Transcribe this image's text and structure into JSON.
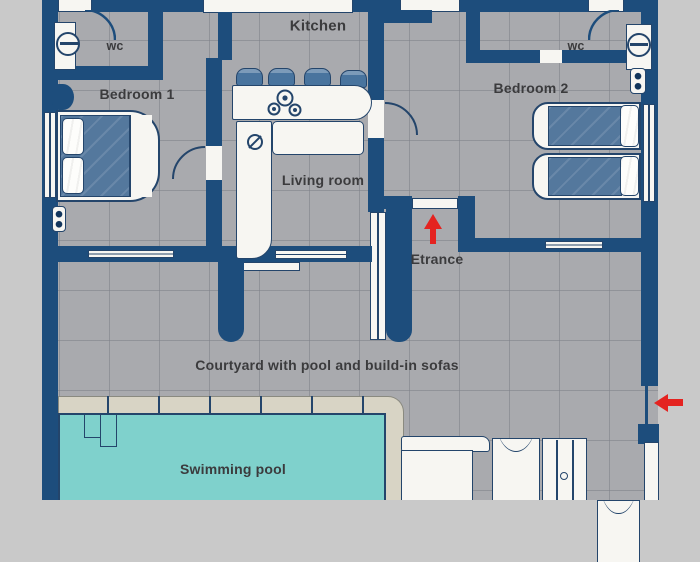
{
  "plan": {
    "type": "floor_plan",
    "labels": {
      "kitchen": "Kitchen",
      "wc_left": "wc",
      "wc_right": "wc",
      "bedroom1": "Bedroom 1",
      "bedroom2": "Bedroom 2",
      "living_room": "Living room",
      "entrance": "Etrance",
      "courtyard": "Courtyard with pool and build-in sofas",
      "pool": "Swimming pool"
    },
    "icons": {
      "entrance_arrow": "red-arrow-up",
      "gate_arrow": "red-arrow-left",
      "stove": "stove-burners-icon",
      "sink": "sink-icon",
      "toilet_left": "toilet-icon",
      "toilet_right": "toilet-icon"
    },
    "colors": {
      "wall": "#1d4d7c",
      "floor": "#a9aaae",
      "background": "#c9c9c9",
      "fixture_fill": "#f7f6f2",
      "fixture_border": "#24456b",
      "bed_blue": "#54789d",
      "chair_blue": "#49749e",
      "pool_water": "#7fd1cc",
      "pool_deck": "#d8d4c5",
      "arrow_red": "#e42320",
      "label_text": "#3b3b3d"
    }
  }
}
